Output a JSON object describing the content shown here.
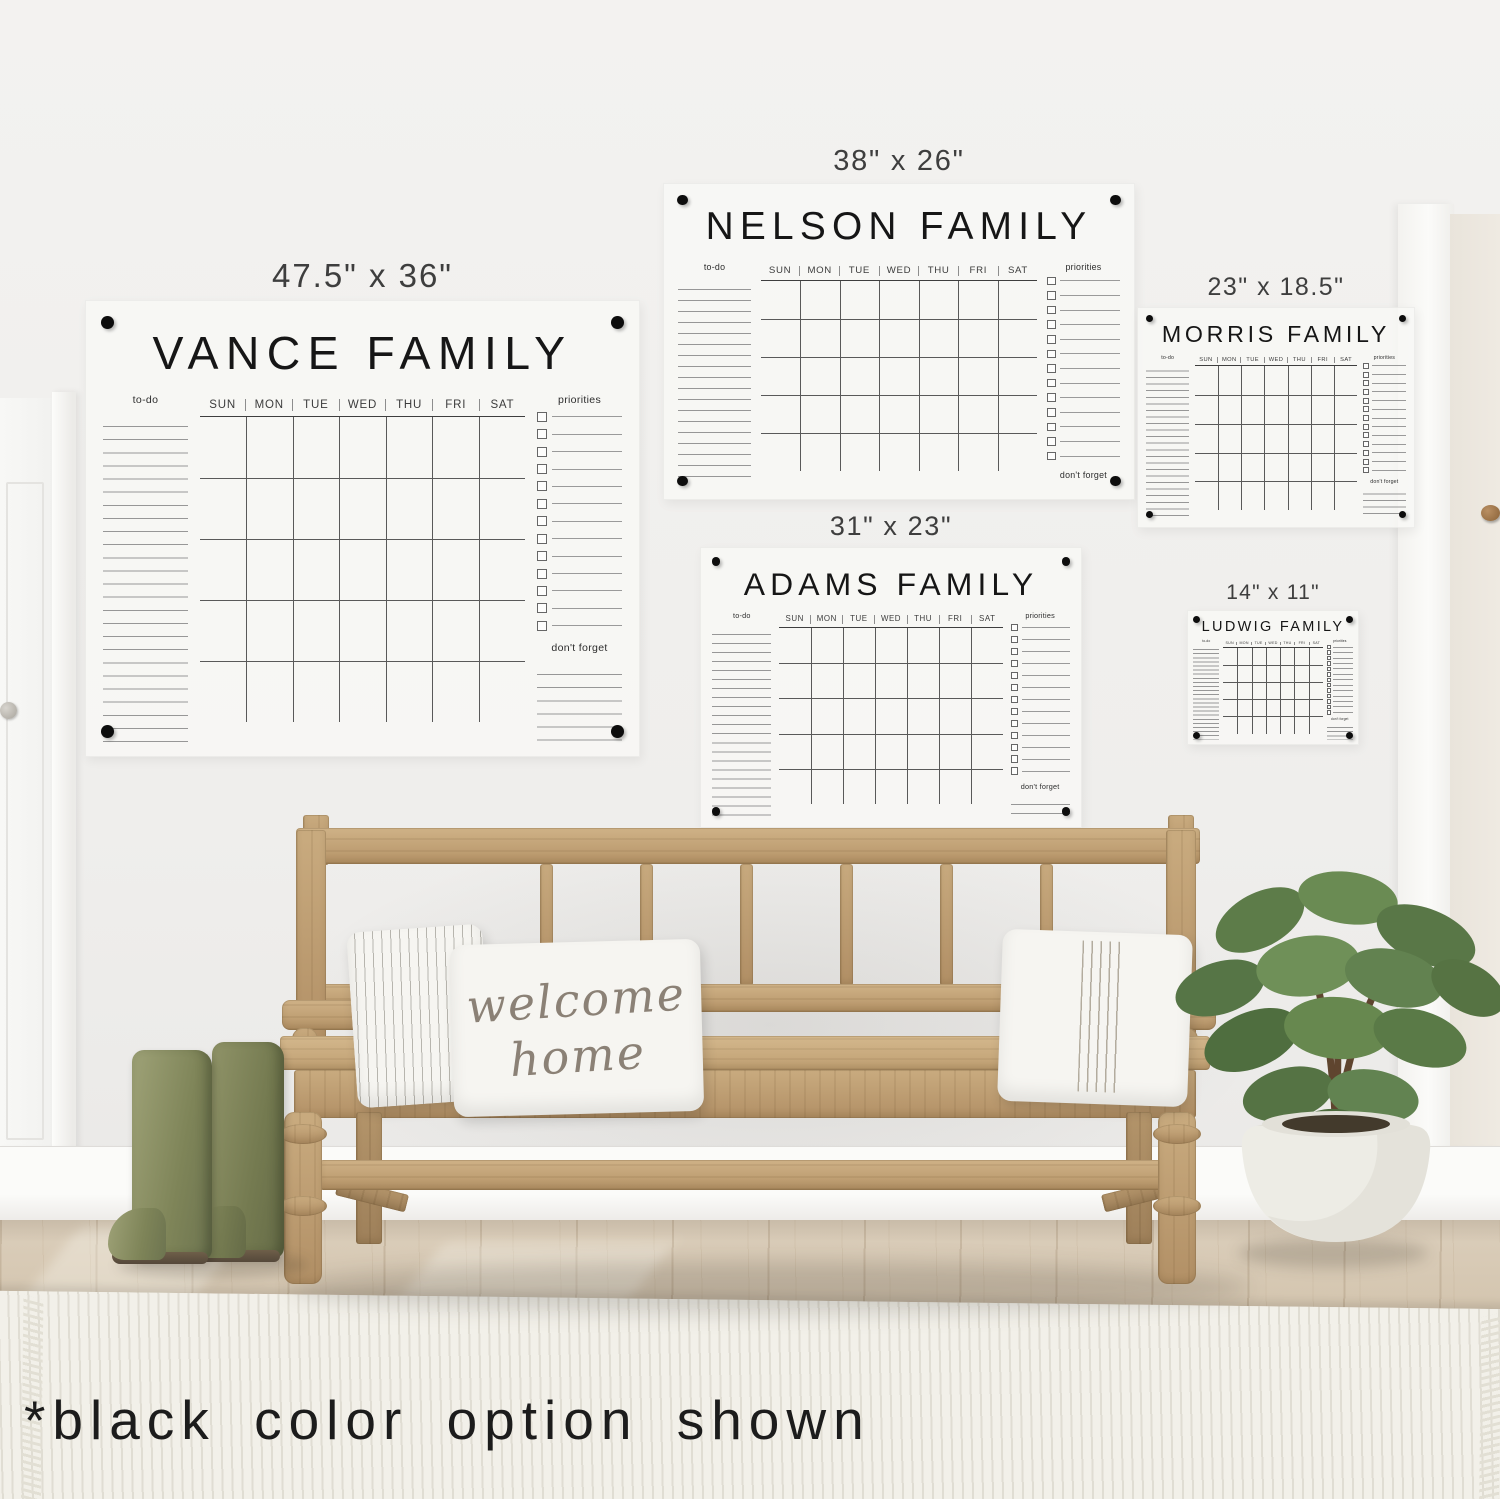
{
  "scene": {
    "caption": "*black color option shown",
    "pillow": {
      "line1": "welcome",
      "line2": "home"
    }
  },
  "calendar_days": [
    "SUN",
    "MON",
    "TUE",
    "WED",
    "THU",
    "FRI",
    "SAT"
  ],
  "calendar_labels": {
    "todo": "to-do",
    "priorities": "priorities",
    "dont_forget": "don't forget"
  },
  "calendars": [
    {
      "title": "VANCE FAMILY",
      "size_label": "47.5\" x 36\""
    },
    {
      "title": "NELSON FAMILY",
      "size_label": "38\" x 26\""
    },
    {
      "title": "MORRIS FAMILY",
      "size_label": "23\" x 18.5\""
    },
    {
      "title": "ADAMS FAMILY",
      "size_label": "31\" x 23\""
    },
    {
      "title": "LUDWIG FAMILY",
      "size_label": "14\" x 11\""
    }
  ],
  "palette": {
    "wall": "#f1f0ee",
    "calendar_text": "#161616",
    "mount_hardware": "#0d0d0d",
    "bench_wood": "#b89268",
    "floor_wood": "#d5c7b1",
    "boots_green": "#7e8458",
    "plant_green": "#5d7c4a",
    "rug": "#eceae2"
  }
}
